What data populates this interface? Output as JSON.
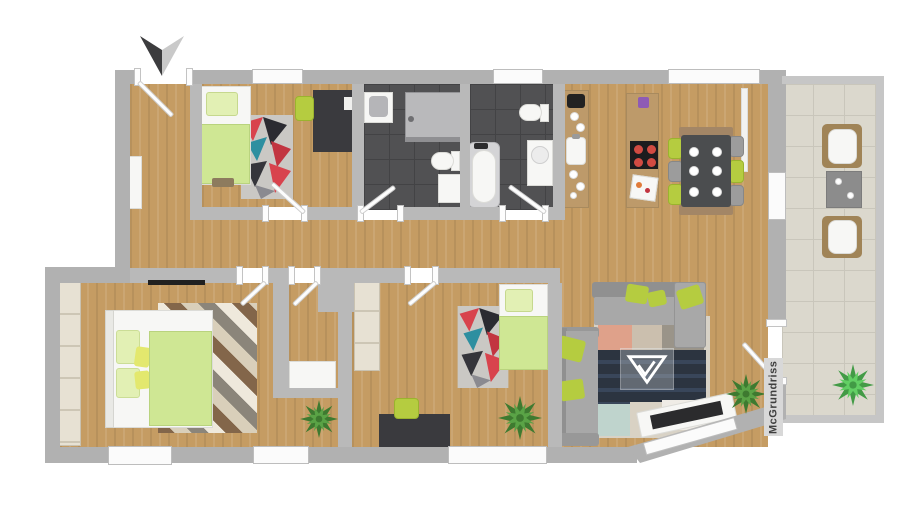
{
  "scene": {
    "kind": "apartment-floor-plan-render"
  },
  "watermark": {
    "text": "McGrundriss"
  },
  "compass": {
    "icon": "north-arrow-icon",
    "points": "down"
  },
  "logo": {
    "icon": "mcgrundriss-triangle-logo"
  },
  "rooms": [
    "entrance-hall",
    "bedroom-1",
    "bathroom-1",
    "bathroom-2",
    "kitchen-dining",
    "hallway",
    "master-bedroom",
    "storage-room",
    "bedroom-2",
    "living-room",
    "balcony"
  ],
  "palette": {
    "bg": "#ffffff",
    "wall_ext": "#b1b1b1",
    "wall_int": "#b9b9b9",
    "wall_balcony": "#c6c6c6",
    "wood": "#c59c63",
    "bath_tile": "#515153",
    "balcony_tile": "#dbd8cd",
    "white_furniture": "#f7f7f5",
    "bedding_green": "#cfe794",
    "pillow_green": "#e2f0b4",
    "pillow_yellow": "#e3e86e",
    "lime": "#b5cc40",
    "sofa_gray": "#a8a8a8",
    "sofa_gray_dark": "#909090",
    "table_dark": "#4b4d4f",
    "desk_dark": "#3a3a3e",
    "wardrobe": "#e7e1d3",
    "wardrobe_line": "#cdc6b5",
    "rug_navy": "#2c3440",
    "rug_salmon": "#dfa18a",
    "wood_furniture": "#bd9a6a",
    "plant_dark": "#3e7a30",
    "plant_light": "#5aa346",
    "text_dark": "#3f3f3f"
  }
}
